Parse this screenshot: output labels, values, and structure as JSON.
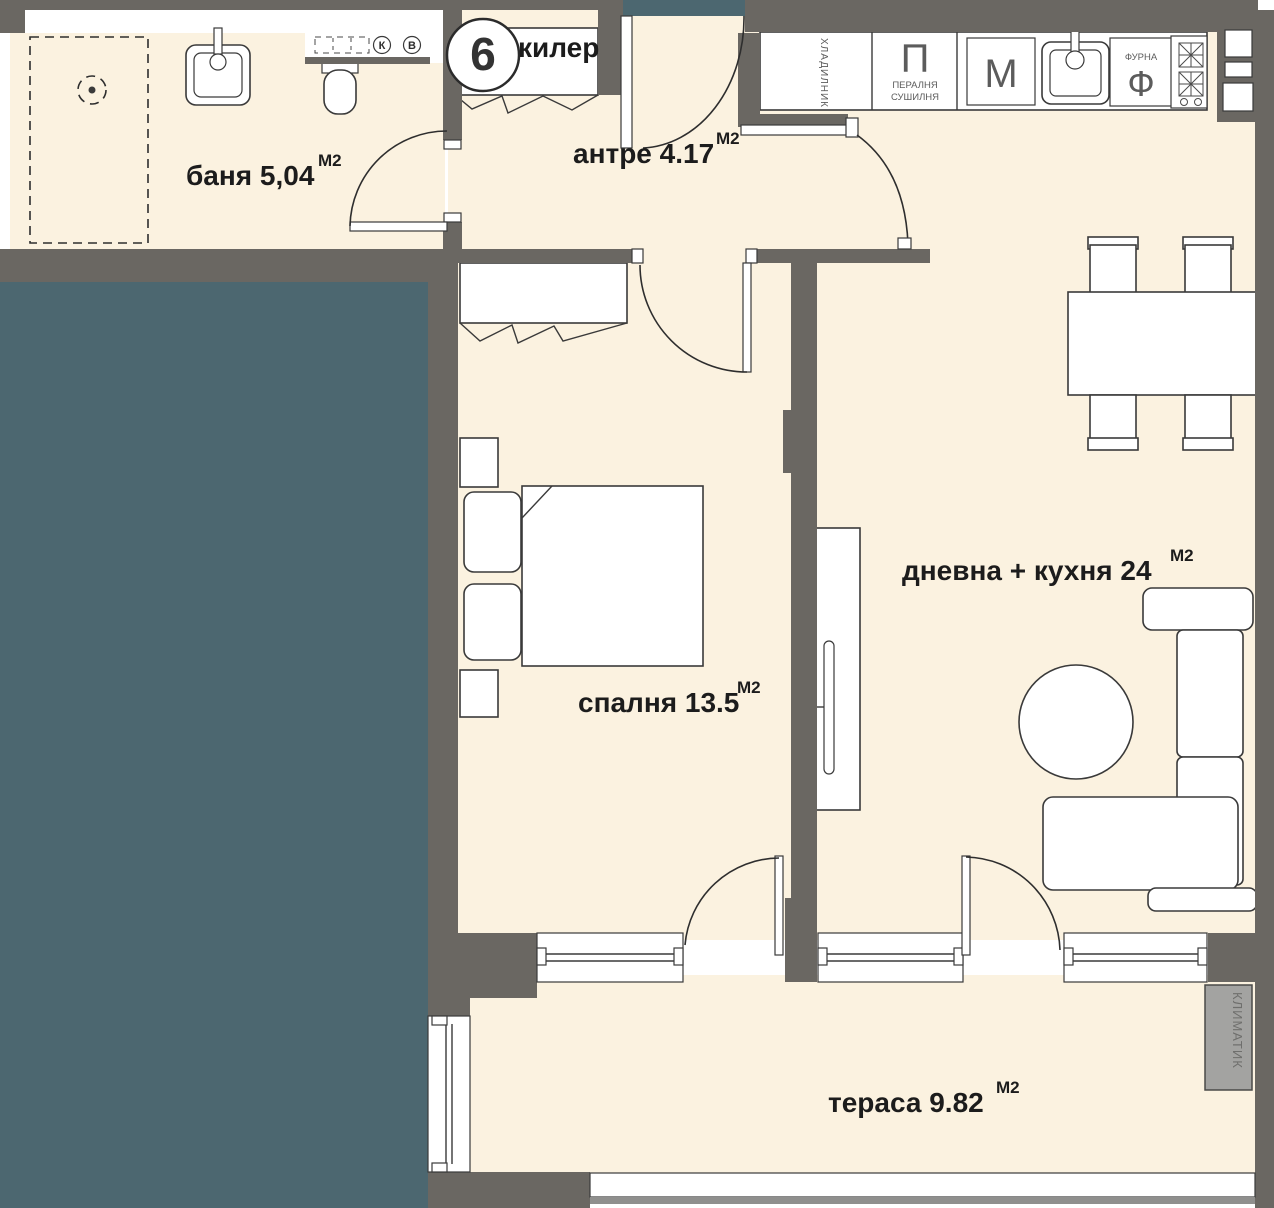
{
  "colors": {
    "wall": "#6a6762",
    "floor": "#fbf2e0",
    "adjacent_area": "#4c6770",
    "outline": "#3a3a3a",
    "label": "#1c1c1c",
    "appliance_text": "#5c5c5c",
    "ac_fill": "#a3a3a1",
    "railing_line": "#8f8f8d"
  },
  "rooms": {
    "banya": {
      "label": "баня 5,04",
      "sup": "М2"
    },
    "kiler": {
      "label": "килер"
    },
    "antre": {
      "label": "антре 4.17",
      "sup": "М2"
    },
    "spalnya": {
      "label": "спалня 13.5",
      "sup": "М2"
    },
    "dnevna": {
      "label": "дневна + кухня 24",
      "sup": "М2"
    },
    "terasa": {
      "label": "тераса 9.82",
      "sup": "М2"
    }
  },
  "kitchen": {
    "fridge_label": "ХЛАДИЛНИК",
    "washer_symbol": "П",
    "washer_line1": "ПЕРАЛНЯ",
    "washer_line2": "СУШИЛНЯ",
    "dishwasher_symbol": "М",
    "oven_label": "ФУРНА",
    "oven_symbol": "Ф"
  },
  "markers": {
    "entrance_number": "9",
    "shaft_k": "К",
    "shaft_v": "В",
    "ac_unit": "КЛИМАТИК"
  }
}
